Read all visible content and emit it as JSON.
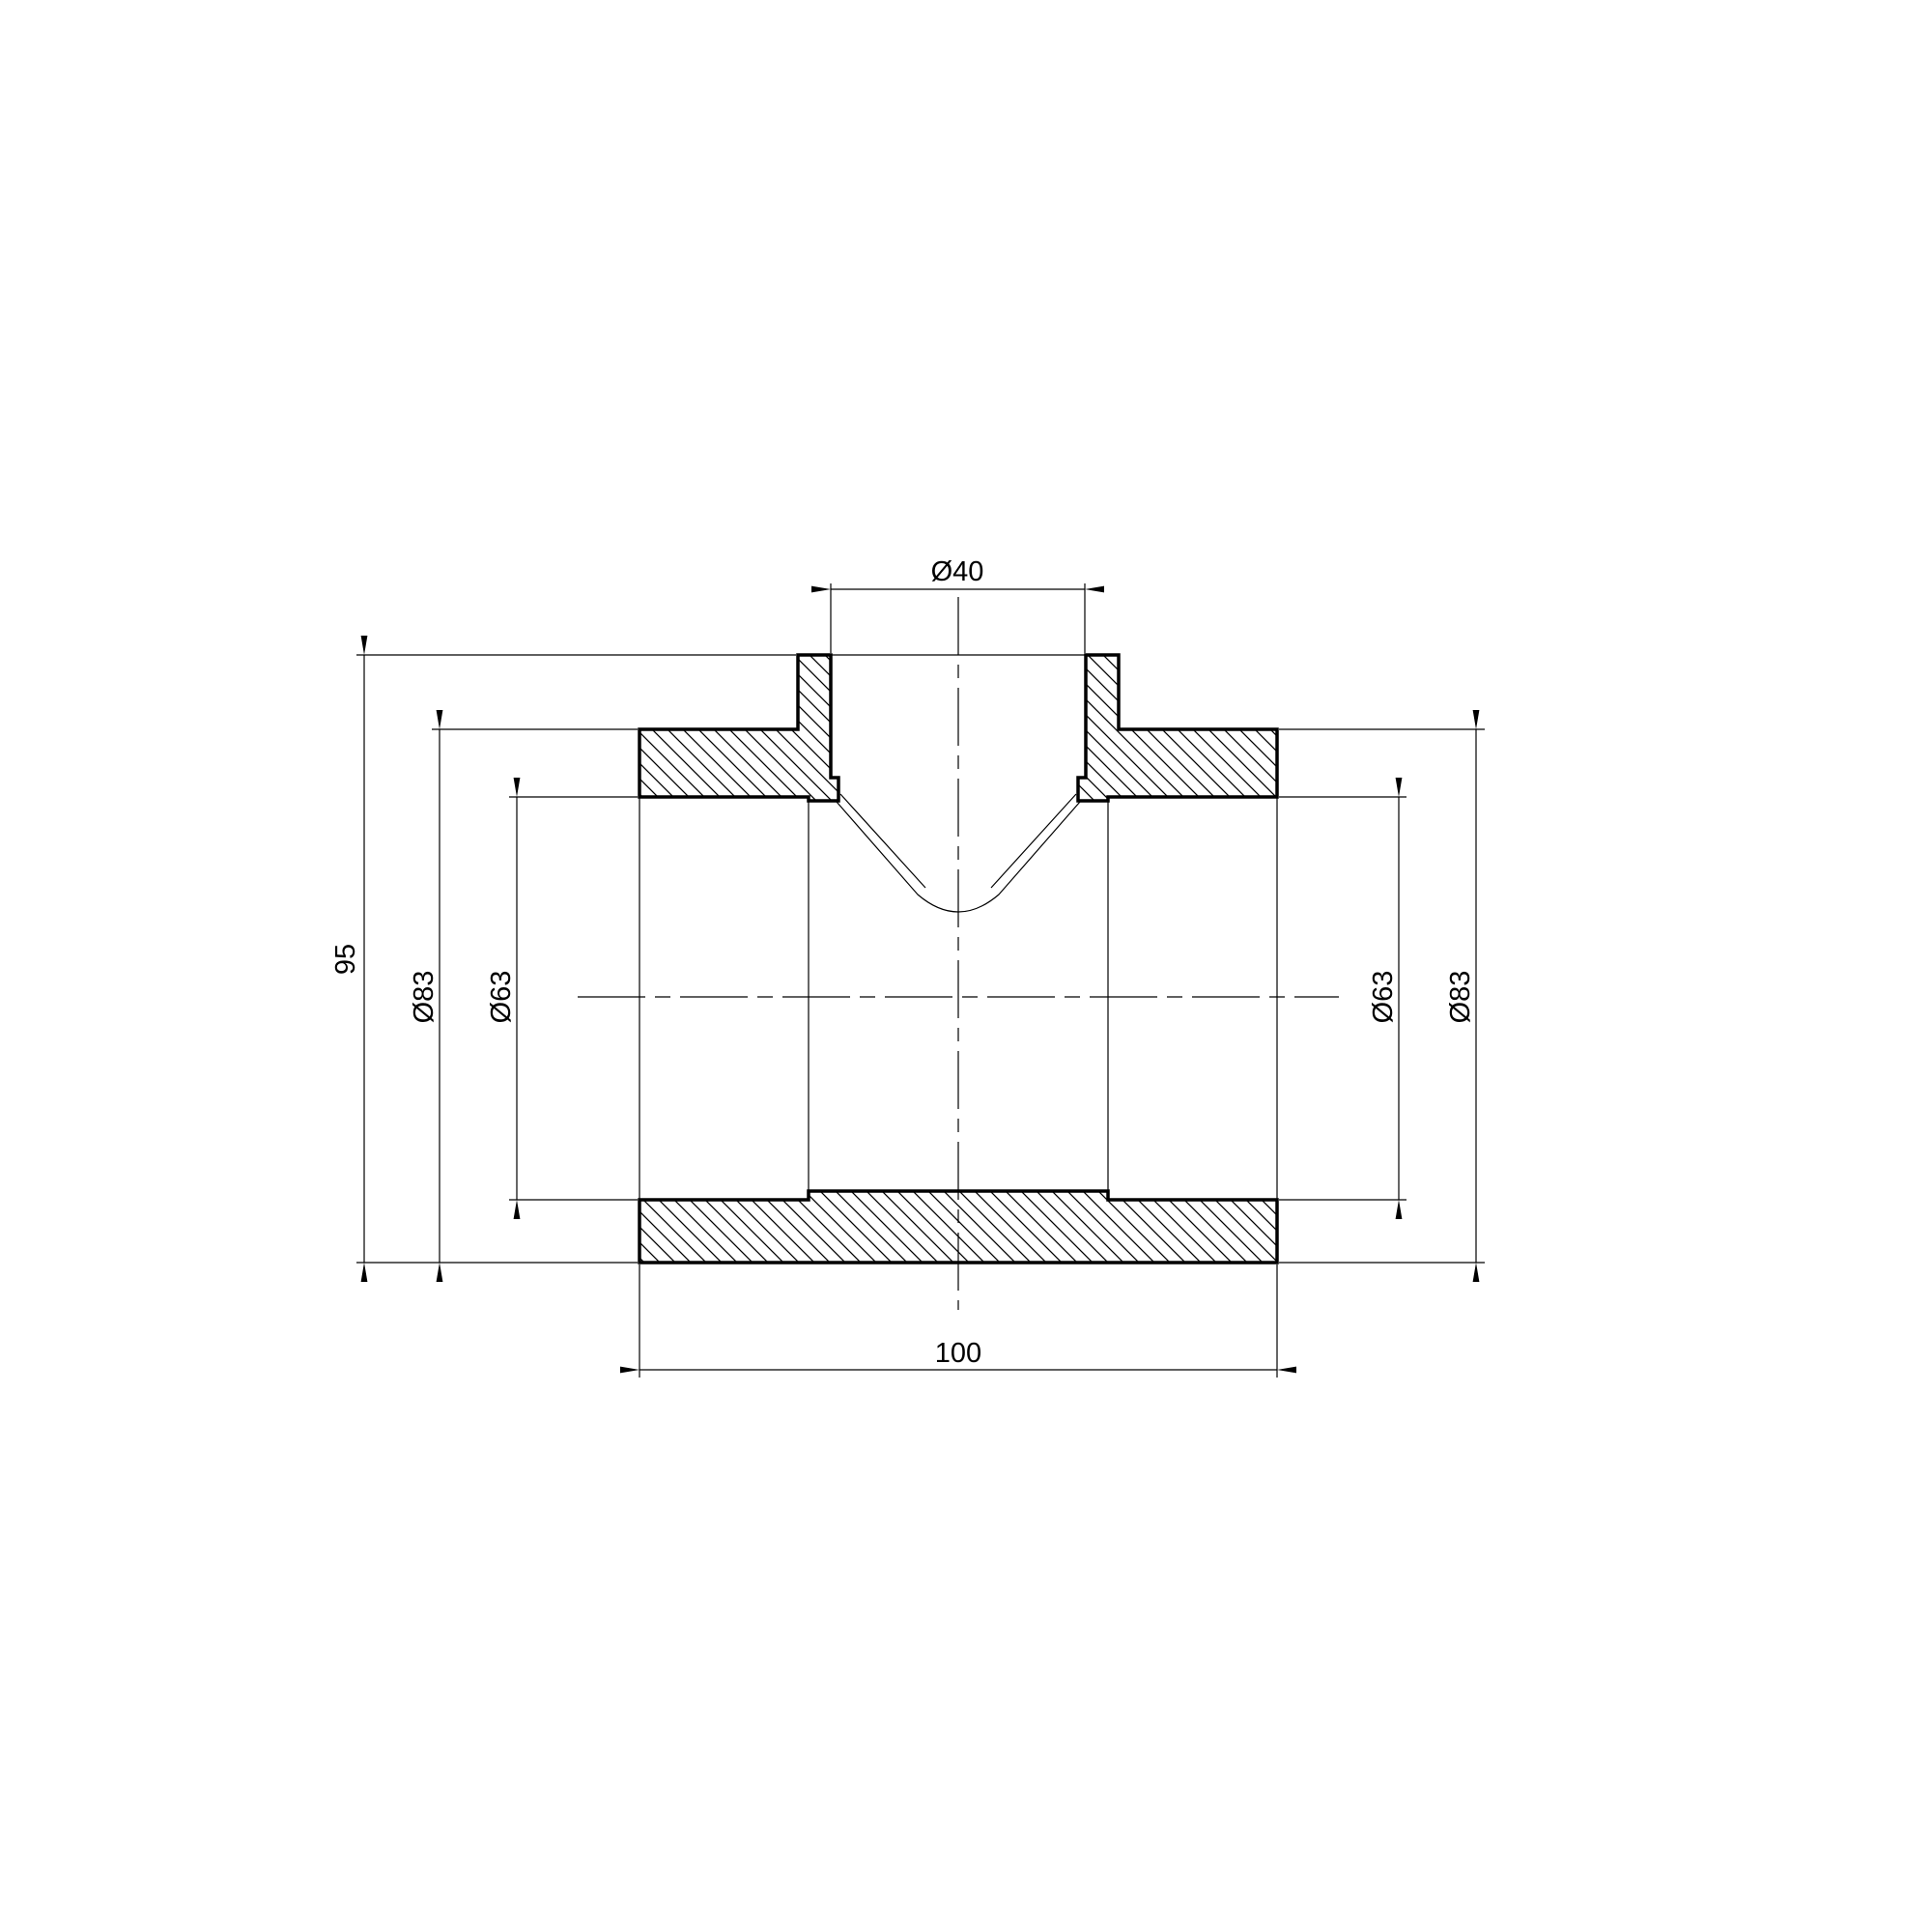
{
  "page": {
    "background": "#ffffff",
    "line_color": "#000000"
  },
  "drawing": {
    "kind": "technical-section-drawing-tee-fitting",
    "labels": {
      "branch_bore": "Ø40",
      "overall_height": "95",
      "left_outer_diameter": "Ø83",
      "left_socket_bore": "Ø63",
      "right_socket_bore": "Ø63",
      "right_outer_diameter": "Ø83",
      "overall_length": "100"
    }
  }
}
